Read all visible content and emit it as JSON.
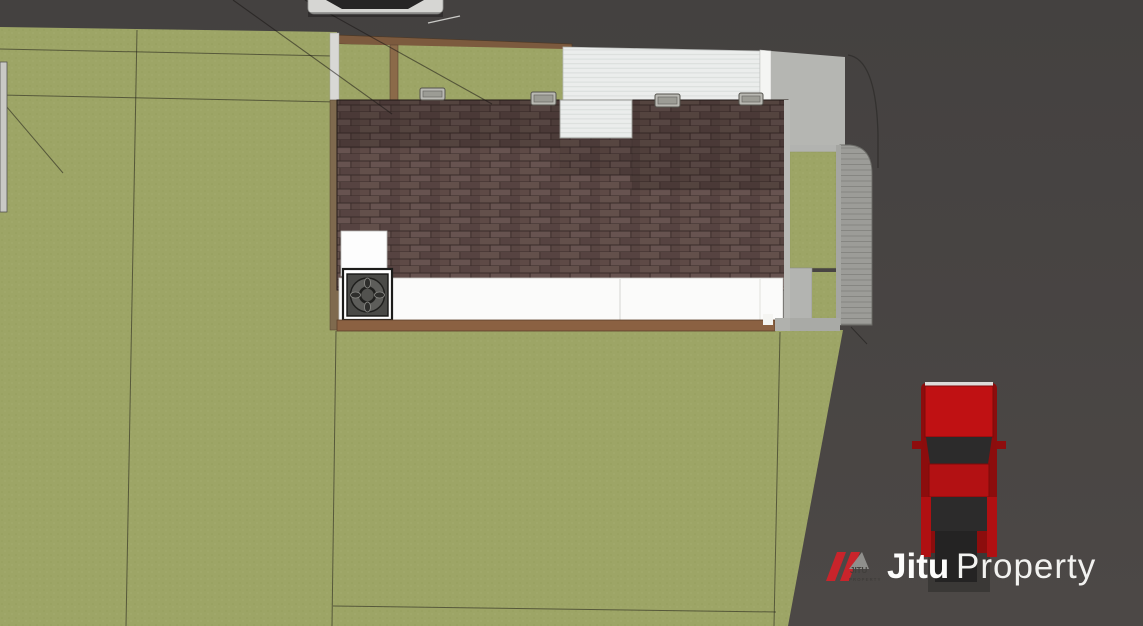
{
  "watermark": {
    "brand_primary": "Jitu",
    "brand_secondary": "Property",
    "logo_icon": "roof-slashes-icon",
    "logo_text_top": "JITU",
    "logo_text_bottom": "PROPERTY"
  },
  "palette": {
    "road": "#494645",
    "grass": "#9da566",
    "roof_shingle": "#5b4845",
    "roof_ridge_shade": "#463634",
    "carport_roof": "#e9ebea",
    "driveway": "#b5b6b2",
    "paver_curb": "#9c9c98",
    "deck_wood": "#8b6142",
    "fence_wood": "#7c5a3e",
    "patio": "#fbfbfa",
    "car_red": "#c01113",
    "logo_red": "#c9242b"
  }
}
